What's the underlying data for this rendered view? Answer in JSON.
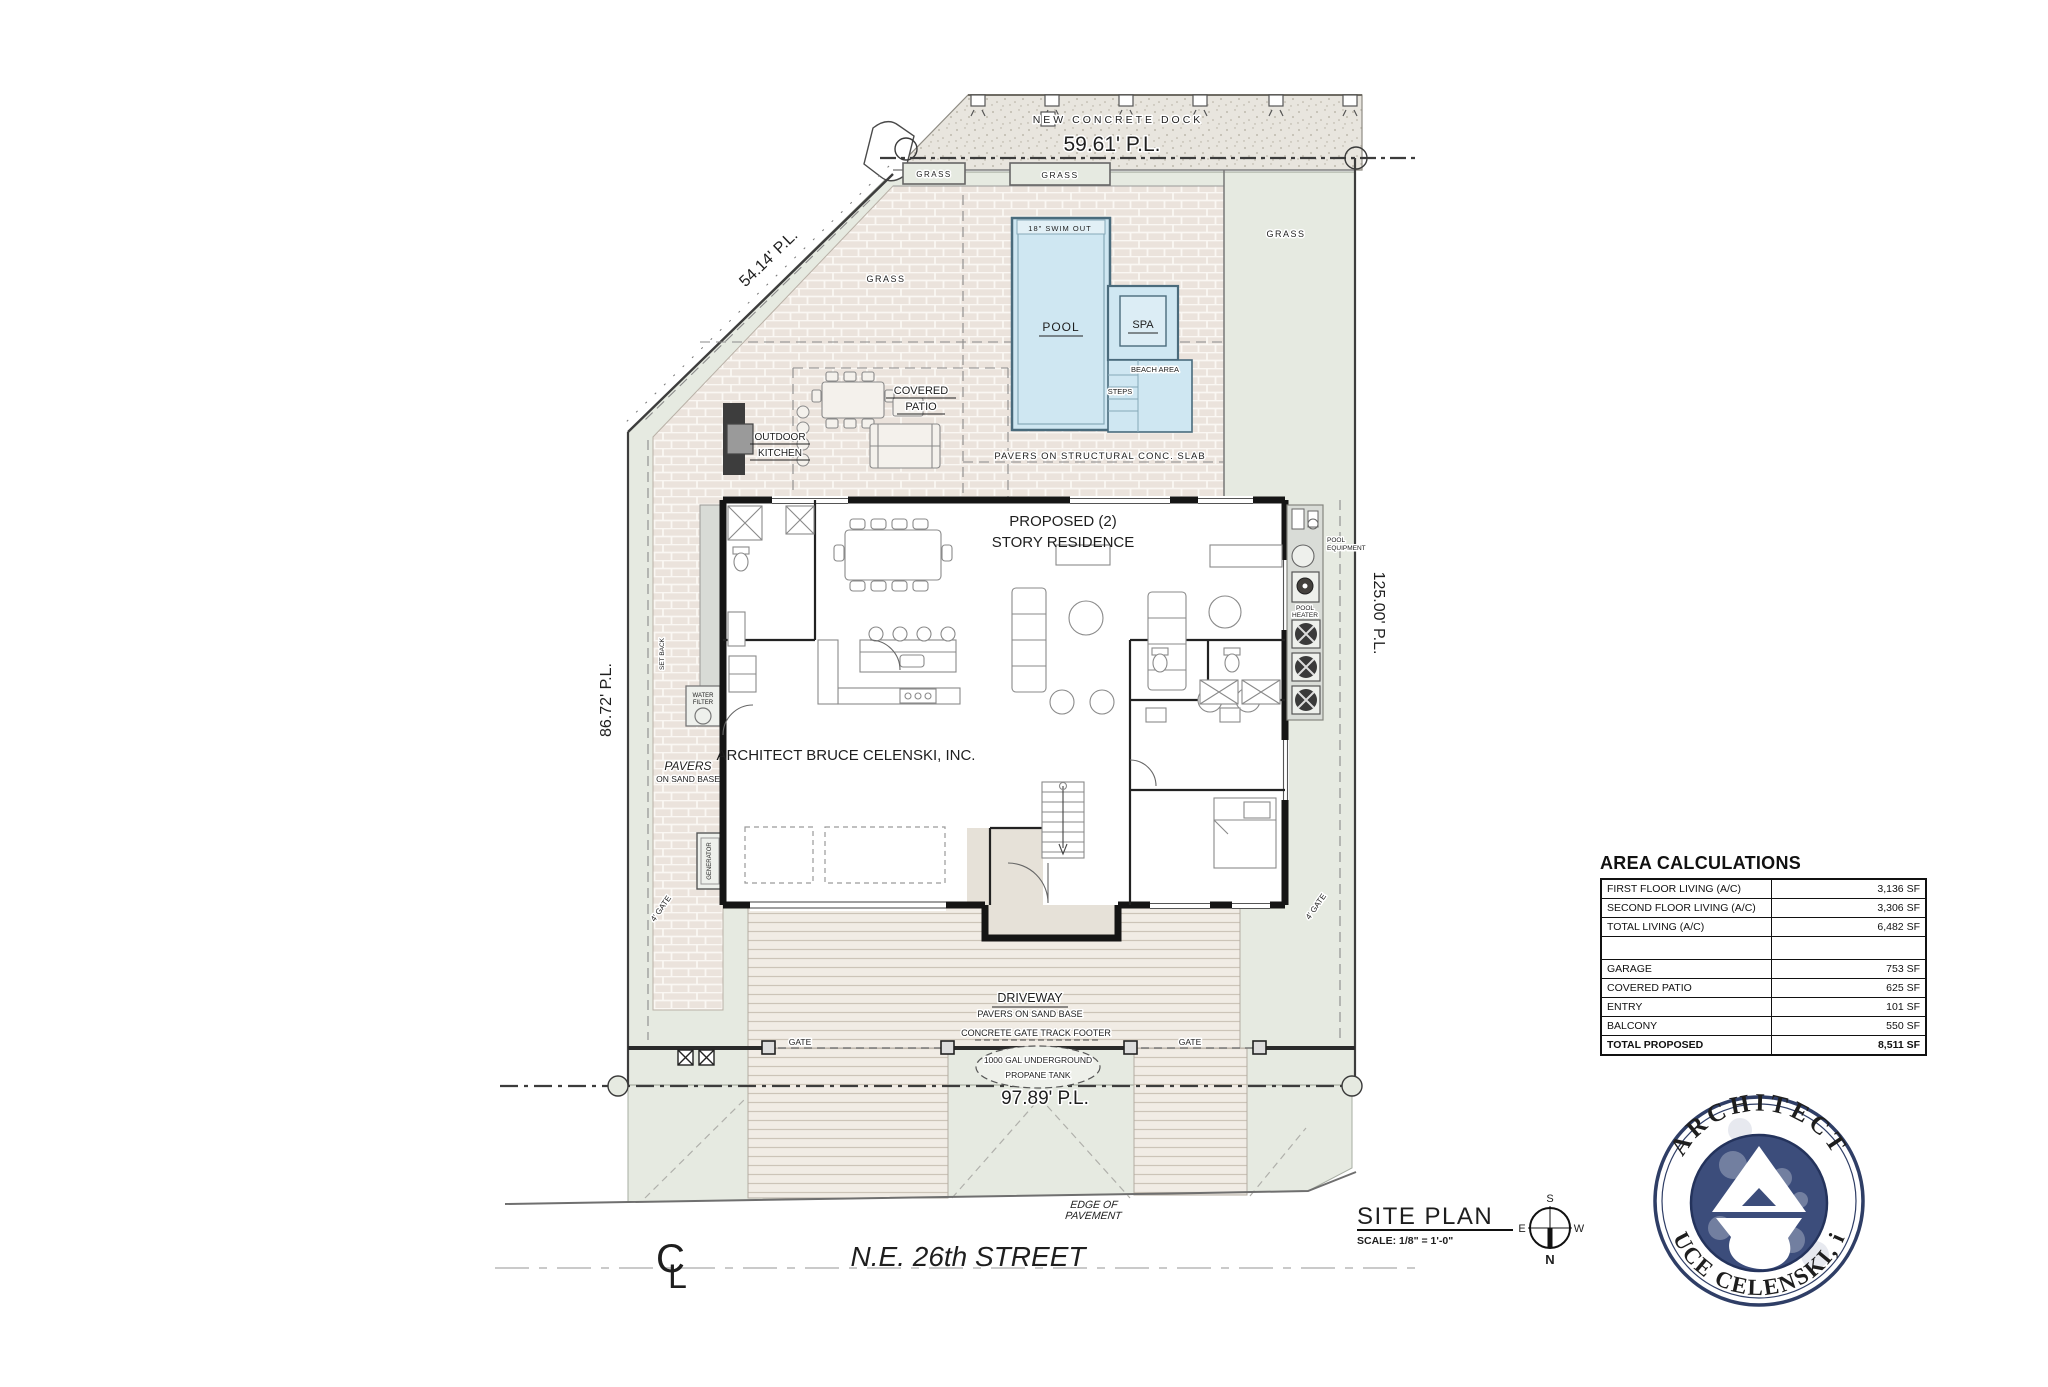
{
  "plan": {
    "dock_label": "NEW CONCRETE DOCK",
    "pl_top": "59.61' P.L.",
    "pl_diag": "54.14' P.L.",
    "pl_left": "86.72' P.L.",
    "pl_right": "125.00' P.L.",
    "pl_bottom": "97.89' P.L.",
    "grass": "GRASS",
    "swim_out": "18\" SWIM OUT",
    "pool": "POOL",
    "spa": "SPA",
    "beach_area": "BEACH AREA",
    "steps": "STEPS",
    "covered_patio": [
      "COVERED",
      "PATIO"
    ],
    "outdoor_kitchen": [
      "OUTDOOR",
      "KITCHEN"
    ],
    "pavers_structural": "PAVERS ON STRUCTURAL CONC. SLAB",
    "residence": [
      "PROPOSED (2)",
      "STORY RESIDENCE"
    ],
    "architect_note": "ARCHITECT BRUCE CELENSKI, INC.",
    "pool_equipment": [
      "POOL",
      "EQUIPMENT"
    ],
    "pool_heater": [
      "POOL",
      "HEATER"
    ],
    "water_filter": [
      "WATER",
      "FILTER"
    ],
    "generator": "GENERATOR",
    "set_back": "SET BACK",
    "pavers_sand": [
      "PAVERS",
      "ON SAND BASE"
    ],
    "driveway": "DRIVEWAY",
    "driveway_sub": "PAVERS ON SAND BASE",
    "gate_track": "CONCRETE GATE TRACK FOOTER",
    "gate": "GATE",
    "gate_4": "4' GATE",
    "propane": [
      "1000 GAL UNDERGROUND",
      "PROPANE TANK"
    ],
    "edge_of_pavement": [
      "EDGE OF",
      "PAVEMENT"
    ]
  },
  "street": {
    "name": "N.E. 26th STREET",
    "cl_c": "C",
    "cl_l": "L"
  },
  "titleblock": {
    "title": "SITE PLAN",
    "scale": "SCALE: 1/8\" = 1'-0\""
  },
  "compass": {
    "n": "N",
    "s": "S",
    "e": "E",
    "w": "W"
  },
  "area_table": {
    "title": "AREA CALCULATIONS",
    "rows": [
      {
        "label": "FIRST FLOOR LIVING (A/C)",
        "value": "3,136 SF"
      },
      {
        "label": "SECOND FLOOR LIVING (A/C)",
        "value": "3,306 SF"
      },
      {
        "label": "TOTAL LIVING (A/C)",
        "value": "6,482 SF"
      },
      {
        "label": "",
        "value": ""
      },
      {
        "label": "GARAGE",
        "value": "753 SF"
      },
      {
        "label": "COVERED PATIO",
        "value": "625 SF"
      },
      {
        "label": "ENTRY",
        "value": "101 SF"
      },
      {
        "label": "BALCONY",
        "value": "550 SF"
      },
      {
        "label": "TOTAL PROPOSED",
        "value": "8,511 SF"
      }
    ]
  },
  "logo": {
    "arc_top": "ARCHITECT",
    "arc_bottom": "BRUCE CELENSKI, inc."
  },
  "colors": {
    "site_green": "#e6eae1",
    "pool_blue": "#cfe7f2",
    "paver": "#ebe3dc",
    "navy": "#3a4b7a"
  }
}
